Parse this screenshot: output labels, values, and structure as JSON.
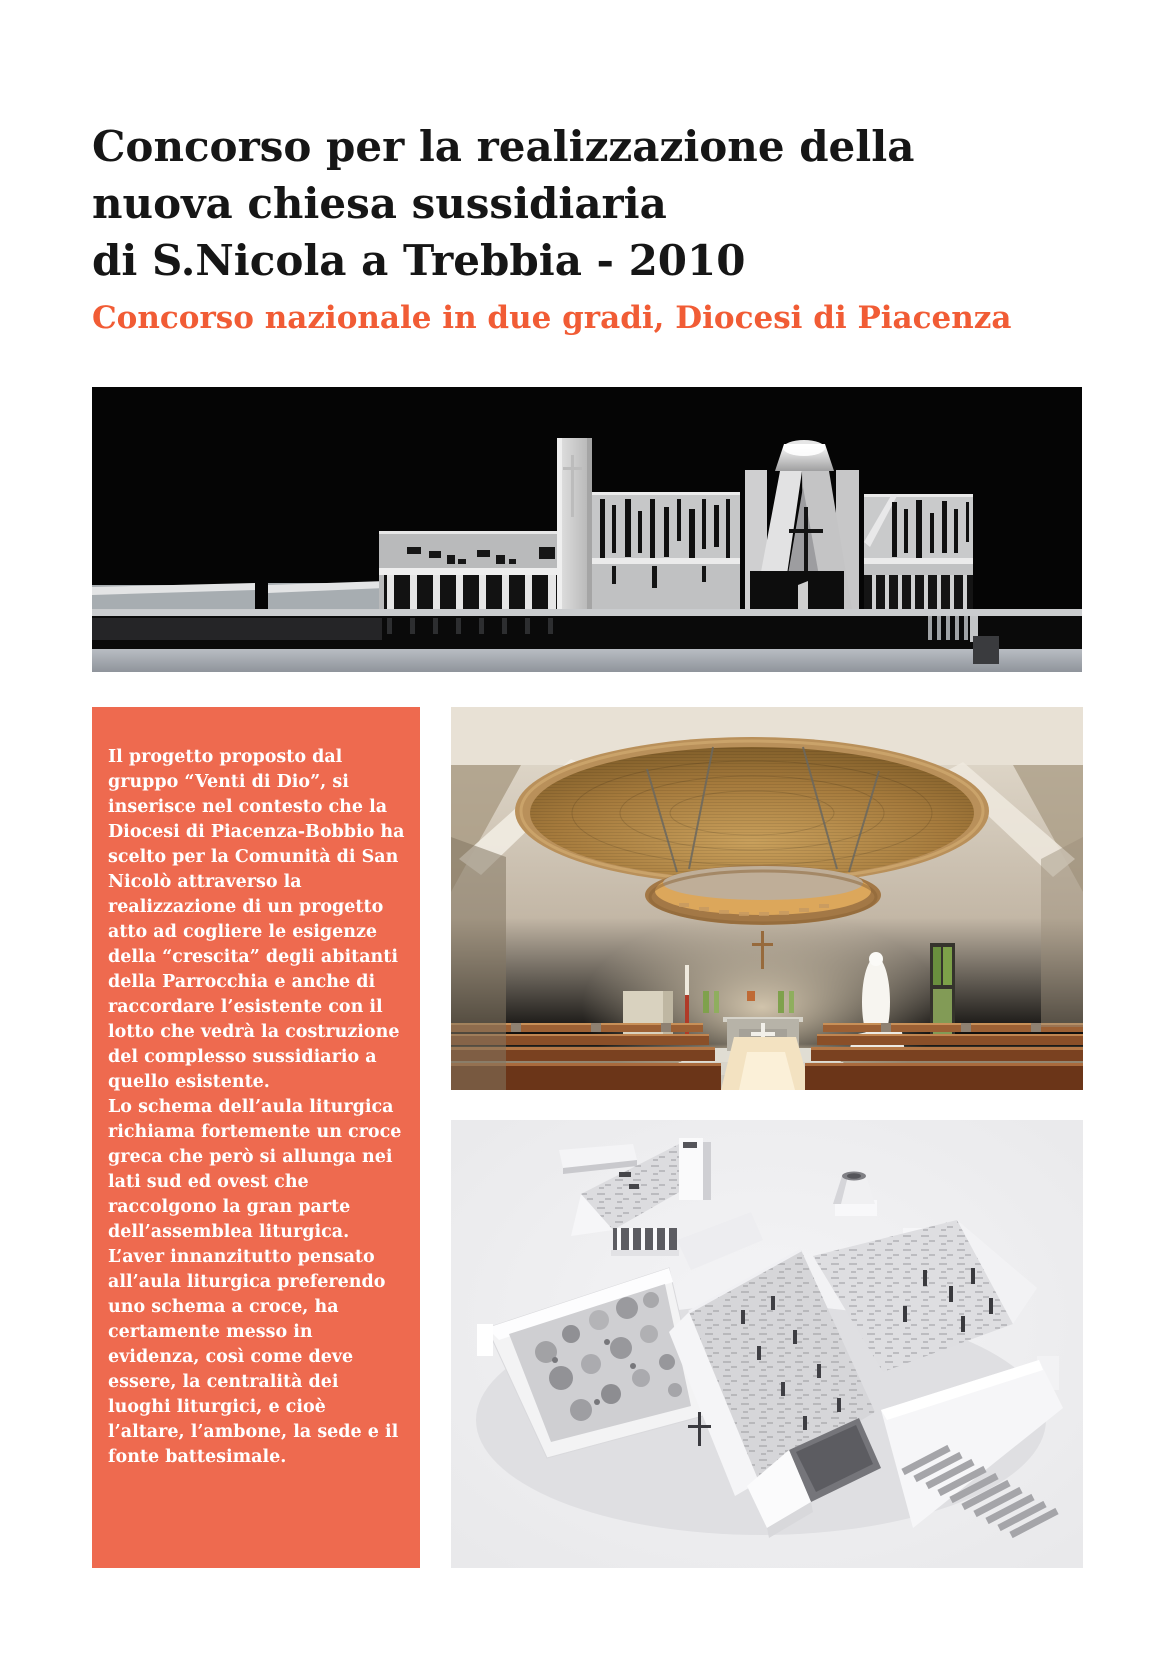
{
  "header": {
    "title_lines": [
      "Concorso per la realizzazione della",
      "nuova chiesa sussidiaria",
      "di S.Nicola a Trebbia - 2010"
    ],
    "subtitle": "Concorso nazionale in due gradi,  Diocesi di Piacenza"
  },
  "description_panel": {
    "paragraphs": [
      "Il progetto proposto dal gruppo “Venti di Dio”, si inserisce nel contesto che la Diocesi di Piacenza-Bobbio ha scelto per la Comunità di San Nicolò attraverso la realizzazione di un progetto atto ad cogliere le esigenze della “crescita” degli abitanti della Parrocchia e anche di raccordare l’esistente con il lotto che vedrà la costruzione del complesso sussidiario a quello esistente.",
      "Lo schema dell’aula liturgica richiama fortemente un croce greca che però si allunga nei lati sud ed ovest che raccolgono la gran parte dell’assemblea liturgica.",
      "L’aver innanzitutto pensato all’aula liturgica preferendo uno schema a croce, ha certamente messo in evidenza, così come deve essere, la centralità dei luoghi liturgici, e cioè l’altare, l’ambone, la sede e il fonte battesimale."
    ]
  },
  "colors": {
    "accent_orange_text": "#f15c35",
    "panel_orange": "#ee6a4f",
    "title_black": "#161616",
    "elevation_background": "#050505",
    "model_background": "#e9e9eb"
  }
}
